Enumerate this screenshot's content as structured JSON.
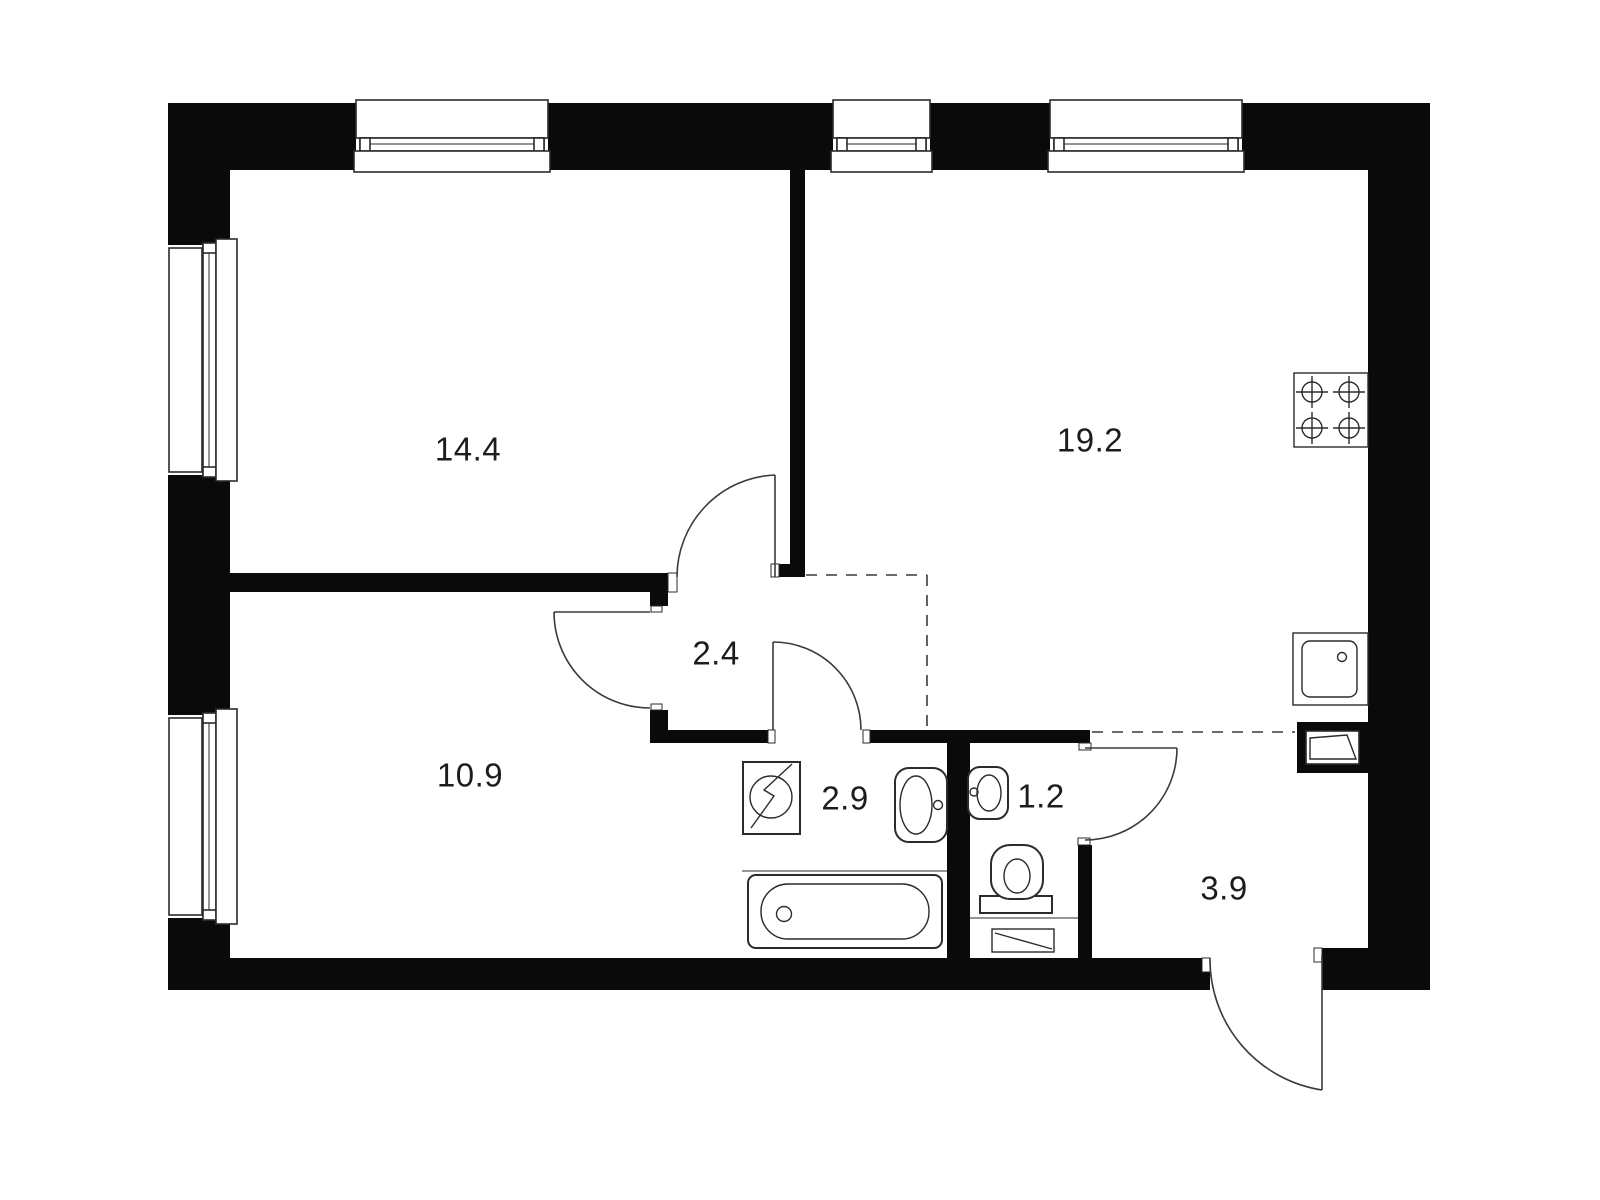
{
  "title": "Apartment floor plan",
  "colors": {
    "wall": "#0a0a0a",
    "line": "#2b2b2b",
    "background": "#ffffff",
    "label": "#1c1c1c"
  },
  "units": "m2",
  "rooms": [
    {
      "id": "living-room",
      "area": "14.4"
    },
    {
      "id": "kitchen-living",
      "area": "19.2"
    },
    {
      "id": "hallway",
      "area": "2.4"
    },
    {
      "id": "bedroom",
      "area": "10.9"
    },
    {
      "id": "bathroom",
      "area": "2.9"
    },
    {
      "id": "wc",
      "area": "1.2"
    },
    {
      "id": "entrance-hall",
      "area": "3.9"
    }
  ],
  "fixtures": [
    {
      "id": "stove-icon",
      "label": "4-burner hob"
    },
    {
      "id": "kitchen-sink-icon",
      "label": "kitchen sink"
    },
    {
      "id": "vent-shaft-icon",
      "label": "ventilation shaft"
    },
    {
      "id": "washing-machine-icon",
      "label": "washing machine"
    },
    {
      "id": "bathtub-icon",
      "label": "bathtub"
    },
    {
      "id": "bathroom-sink-icon",
      "label": "wash basin"
    },
    {
      "id": "wc-sink-icon",
      "label": "small wash basin"
    },
    {
      "id": "toilet-icon",
      "label": "toilet"
    },
    {
      "id": "wc-cabinet-icon",
      "label": "cabinet"
    }
  ],
  "windows": {
    "count": 5
  },
  "doors": {
    "count": 6
  }
}
